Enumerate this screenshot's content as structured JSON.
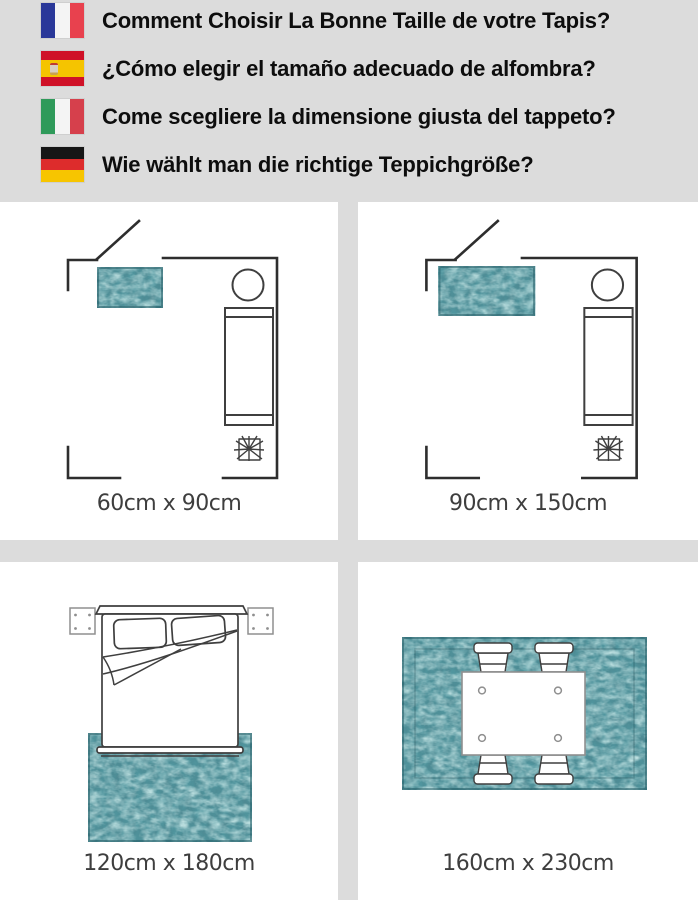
{
  "title": "rug size guide infographic",
  "header": {
    "items": [
      {
        "lang": "fr",
        "flag_name": "france-flag",
        "flag": {
          "orientation": "vertical",
          "stripes": [
            "#2a3899",
            "#f4f4f4",
            "#e8414e"
          ]
        },
        "text": "Comment Choisir La Bonne Taille de votre Tapis?"
      },
      {
        "lang": "es",
        "flag_name": "spain-flag",
        "flag": {
          "orientation": "horizontal",
          "stripes": [
            "#cf1127",
            "#f5c400",
            "#cf1127"
          ],
          "sizes": [
            25,
            50,
            25
          ],
          "emblem_colors": [
            "#bf3a33",
            "#d8cfc0",
            "#c9a24f"
          ]
        },
        "text": "¿Cómo elegir el tamaño adecuado de alfombra?"
      },
      {
        "lang": "it",
        "flag_name": "italy-flag",
        "flag": {
          "orientation": "vertical",
          "stripes": [
            "#2f9a5a",
            "#f4f4f4",
            "#d6404c"
          ]
        },
        "text": "Come scegliere la dimensione giusta del tappeto?"
      },
      {
        "lang": "de",
        "flag_name": "germany-flag",
        "flag": {
          "orientation": "horizontal",
          "stripes": [
            "#161616",
            "#dd2c2c",
            "#f7c500"
          ]
        },
        "text": "Wie wählt man die richtige Teppichgröße?"
      }
    ]
  },
  "panels": [
    {
      "scene": "living-room-small-rug",
      "label": "60cm x 90cm",
      "rug_width_cm": 60,
      "rug_length_cm": 90
    },
    {
      "scene": "living-room-medium-rug",
      "label": "90cm x 150cm",
      "rug_width_cm": 90,
      "rug_length_cm": 150
    },
    {
      "scene": "bedroom-rug",
      "label": "120cm x 180cm",
      "rug_width_cm": 120,
      "rug_length_cm": 180
    },
    {
      "scene": "dining-room-rug",
      "label": "160cm x 230cm",
      "rug_width_cm": 160,
      "rug_length_cm": 230
    }
  ],
  "theme": {
    "page_bg": "#dcdcdc",
    "panel_bg": "#ffffff",
    "header_text": "#0d0d0d",
    "label_color": "#3e3e3e",
    "line_dark": "#2e2e2e",
    "line_mid": "#3f3f3f",
    "line_light": "#8f8f8f",
    "rug_base": "#4d868f"
  }
}
